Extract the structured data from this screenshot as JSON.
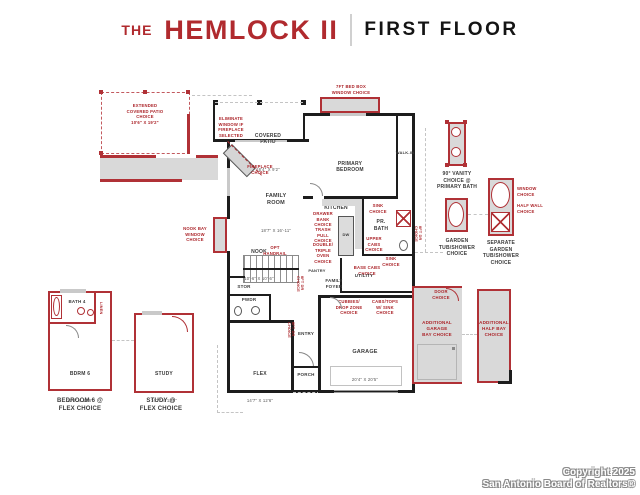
{
  "header": {
    "brand_prefix": "THE",
    "brand_name": "HEMLOCK II",
    "floor_title": "FIRST FLOOR"
  },
  "colors": {
    "brand_red": "#b02a2e",
    "wall_black": "#1d1d1d",
    "floor_gray": "#d9d9d9"
  },
  "rooms": {
    "covered_patio": {
      "name": "COVERED\nPATIO",
      "dim": "18'4\" X 9'2\""
    },
    "primary_bedroom": {
      "name": "PRIMARY\nBEDROOM",
      "dim": "13'-2\" X 14'-2\""
    },
    "walk_in": {
      "name": "WALK-IN"
    },
    "family_room": {
      "name": "FAMILY\nROOM",
      "dim": "18'7\" X 16'-11\""
    },
    "kitchen": {
      "name": "KITCHEN"
    },
    "nook": {
      "name": "NOOK",
      "dim": "10'-6\" X 10'-6\""
    },
    "pr_bath": {
      "name": "PR.\nBATH"
    },
    "pantry": {
      "name": "PANTRY"
    },
    "stor": {
      "name": "STOR"
    },
    "family_foyer": {
      "name": "FAMILY\nFOYER"
    },
    "utility": {
      "name": "UTILITY"
    },
    "pwdr": {
      "name": "PWDR"
    },
    "entry": {
      "name": "ENTRY"
    },
    "flex": {
      "name": "FLEX",
      "dim": "14'7\" X 12'6\""
    },
    "porch": {
      "name": "PORCH"
    },
    "garage": {
      "name": "GARAGE",
      "dim": "20'4\" X 20'5\""
    },
    "dw": "DW",
    "bath4": {
      "name": "BATH 4"
    },
    "linen": {
      "name": "LINEN"
    },
    "bdrm6": {
      "name": "BDRM 6",
      "dim": "12'8\" X 12'6\""
    },
    "study": {
      "name": "STUDY",
      "dim": "14'7\" X 12'6\""
    }
  },
  "options": {
    "extended_patio": "EXTENDED\nCOVERED PATIO\nCHOICE\n10'6\" X 19'2\"",
    "eliminate_window": "ELIMINATE\nWINDOW IF\nFIREPLACE\nSELECTED",
    "fireplace": "FIREPLACE\nCHOICE",
    "bed_box_window": "7FT BED BOX\nWINDOW CHOICE",
    "nook_bay_window": "NOOK BAY\nWINDOW\nCHOICE",
    "opt_handrail": "OPT\nHANDRAIL",
    "drawer_bank": "DRAWER\nBANK\nCHOICE",
    "trash_pull": "TRASH\nPULL\nCHOICE",
    "double_triple_oven": "DOUBLE/\nTRIPLE\nOVEN\nCHOICE",
    "sink_upper": "SINK\nCHOICE",
    "upper_cabs": "UPPER\nCABS\nCHOICE",
    "sink_lower": "SINK\nCHOICE",
    "base_cabs": "BASE CABS\nCHOICE",
    "door_8ft_a": "8FT DR CHOICE",
    "door_8ft_b": "8FT DR CHOICE",
    "door_8ft_c": "8FT DR CHOICE",
    "cubbies_drop_zone": "CUBBIES/\nDROP ZONE\nCHOICE",
    "cabs_tops_sink": "CABS/TOPS\nW/ SINK\nCHOICE",
    "door_choice": "DOOR\nCHOICE",
    "additional_garage_bay": "ADDITIONAL\nGARAGE\nBAY CHOICE",
    "additional_half_bay": "ADDITIONAL\nHALF BAY\nCHOICE",
    "window_choice": "WINDOW\nCHOICE",
    "half_wall": "HALF WALL\nCHOICE"
  },
  "captions": {
    "vanity": "90° VANITY\nCHOICE @\nPRIMARY BATH",
    "garden_tub": "GARDEN\nTUB/SHOWER\nCHOICE",
    "separate_garden_tub": "SEPARATE\nGARDEN\nTUB/SHOWER\nCHOICE",
    "bedroom6_flex": "BEDROOM 6 @\nFLEX CHOICE",
    "study_flex": "STUDY @\nFLEX CHOICE"
  },
  "footer": {
    "copyright": "Copyright 2025",
    "org": "San Antonio Board of Realtors®"
  }
}
